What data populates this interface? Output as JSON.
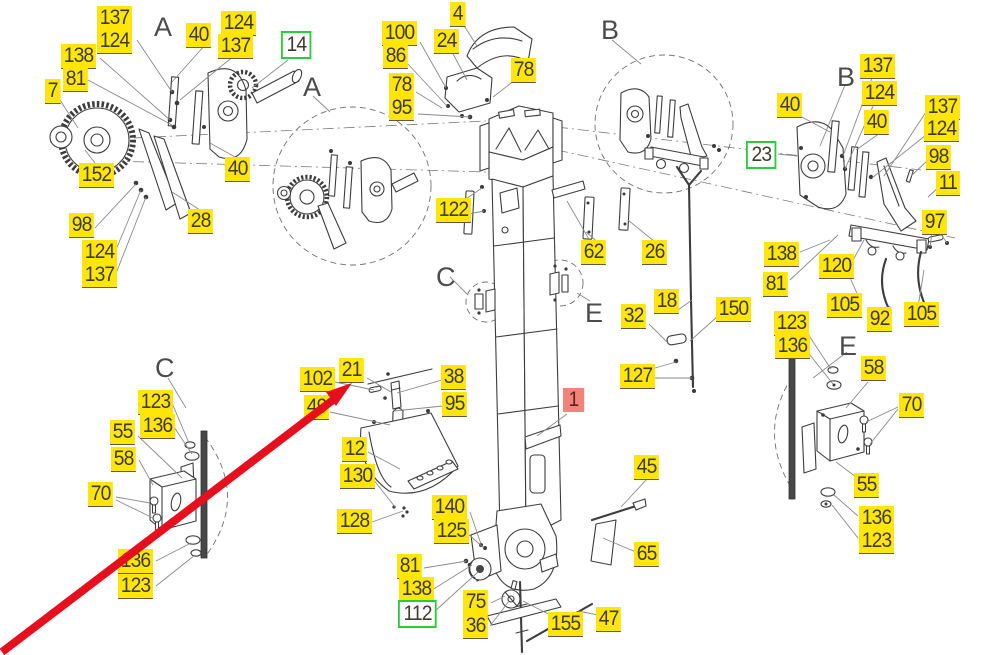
{
  "diagram": {
    "type": "exploded-parts-diagram",
    "colors": {
      "highlight": "#ffe608",
      "highlight_text": "#3f3b2e",
      "underline": "#5f5a48",
      "green_border": "#29cc3d",
      "red_bg": "#f2837b",
      "red_text": "#5c231e",
      "line": "#3d3d3d",
      "leader": "#8a8a8a",
      "arrow": "#e60f1e"
    },
    "labels": [
      {
        "text": "137",
        "x": 97,
        "y": 6,
        "kind": "yellow"
      },
      {
        "text": "124",
        "x": 97,
        "y": 29,
        "kind": "yellow"
      },
      {
        "text": "138",
        "x": 61,
        "y": 44,
        "kind": "yellow"
      },
      {
        "text": "81",
        "x": 63,
        "y": 67,
        "kind": "yellow"
      },
      {
        "text": "7",
        "x": 45,
        "y": 79,
        "kind": "yellow"
      },
      {
        "text": "40",
        "x": 186,
        "y": 23,
        "kind": "yellow"
      },
      {
        "text": "124",
        "x": 221,
        "y": 11,
        "kind": "yellow"
      },
      {
        "text": "137",
        "x": 218,
        "y": 34,
        "kind": "yellow"
      },
      {
        "text": "14",
        "x": 281,
        "y": 31,
        "kind": "green"
      },
      {
        "text": "152",
        "x": 79,
        "y": 163,
        "kind": "yellow"
      },
      {
        "text": "98",
        "x": 69,
        "y": 213,
        "kind": "yellow"
      },
      {
        "text": "124",
        "x": 82,
        "y": 240,
        "kind": "yellow"
      },
      {
        "text": "137",
        "x": 82,
        "y": 263,
        "kind": "yellow"
      },
      {
        "text": "28",
        "x": 188,
        "y": 209,
        "kind": "yellow"
      },
      {
        "text": "40",
        "x": 225,
        "y": 157,
        "kind": "yellow"
      },
      {
        "text": "100",
        "x": 382,
        "y": 21,
        "kind": "yellow"
      },
      {
        "text": "86",
        "x": 383,
        "y": 44,
        "kind": "yellow"
      },
      {
        "text": "78",
        "x": 389,
        "y": 73,
        "kind": "yellow"
      },
      {
        "text": "95",
        "x": 389,
        "y": 96,
        "kind": "yellow"
      },
      {
        "text": "4",
        "x": 450,
        "y": 2,
        "kind": "yellow"
      },
      {
        "text": "24",
        "x": 434,
        "y": 29,
        "kind": "yellow"
      },
      {
        "text": "78",
        "x": 511,
        "y": 58,
        "kind": "yellow"
      },
      {
        "text": "40",
        "x": 777,
        "y": 93,
        "kind": "yellow"
      },
      {
        "text": "137",
        "x": 860,
        "y": 54,
        "kind": "yellow"
      },
      {
        "text": "124",
        "x": 862,
        "y": 81,
        "kind": "yellow"
      },
      {
        "text": "40",
        "x": 864,
        "y": 110,
        "kind": "yellow"
      },
      {
        "text": "23",
        "x": 746,
        "y": 141,
        "kind": "green"
      },
      {
        "text": "137",
        "x": 925,
        "y": 95,
        "kind": "yellow"
      },
      {
        "text": "124",
        "x": 924,
        "y": 117,
        "kind": "yellow"
      },
      {
        "text": "98",
        "x": 926,
        "y": 145,
        "kind": "yellow"
      },
      {
        "text": "11",
        "x": 936,
        "y": 171,
        "kind": "yellow"
      },
      {
        "text": "97",
        "x": 922,
        "y": 210,
        "kind": "yellow"
      },
      {
        "text": "138",
        "x": 764,
        "y": 242,
        "kind": "yellow"
      },
      {
        "text": "81",
        "x": 763,
        "y": 272,
        "kind": "yellow"
      },
      {
        "text": "120",
        "x": 819,
        "y": 254,
        "kind": "yellow"
      },
      {
        "text": "105",
        "x": 827,
        "y": 293,
        "kind": "yellow"
      },
      {
        "text": "92",
        "x": 867,
        "y": 307,
        "kind": "yellow"
      },
      {
        "text": "105",
        "x": 904,
        "y": 302,
        "kind": "yellow"
      },
      {
        "text": "123",
        "x": 774,
        "y": 311,
        "kind": "yellow"
      },
      {
        "text": "136",
        "x": 775,
        "y": 334,
        "kind": "yellow"
      },
      {
        "text": "58",
        "x": 861,
        "y": 356,
        "kind": "yellow"
      },
      {
        "text": "70",
        "x": 899,
        "y": 393,
        "kind": "yellow"
      },
      {
        "text": "55",
        "x": 854,
        "y": 473,
        "kind": "yellow"
      },
      {
        "text": "136",
        "x": 859,
        "y": 506,
        "kind": "yellow"
      },
      {
        "text": "123",
        "x": 859,
        "y": 529,
        "kind": "yellow"
      },
      {
        "text": "122",
        "x": 436,
        "y": 198,
        "kind": "yellow"
      },
      {
        "text": "62",
        "x": 581,
        "y": 240,
        "kind": "yellow"
      },
      {
        "text": "26",
        "x": 642,
        "y": 240,
        "kind": "yellow"
      },
      {
        "text": "32",
        "x": 621,
        "y": 304,
        "kind": "yellow"
      },
      {
        "text": "18",
        "x": 654,
        "y": 289,
        "kind": "yellow"
      },
      {
        "text": "150",
        "x": 716,
        "y": 297,
        "kind": "yellow"
      },
      {
        "text": "127",
        "x": 620,
        "y": 364,
        "kind": "yellow"
      },
      {
        "text": "102",
        "x": 300,
        "y": 367,
        "kind": "yellow"
      },
      {
        "text": "21",
        "x": 339,
        "y": 358,
        "kind": "yellow"
      },
      {
        "text": "49",
        "x": 304,
        "y": 395,
        "kind": "yellow"
      },
      {
        "text": "38",
        "x": 441,
        "y": 365,
        "kind": "yellow"
      },
      {
        "text": "95",
        "x": 442,
        "y": 392,
        "kind": "yellow"
      },
      {
        "text": "12",
        "x": 342,
        "y": 437,
        "kind": "yellow"
      },
      {
        "text": "130",
        "x": 340,
        "y": 464,
        "kind": "yellow"
      },
      {
        "text": "128",
        "x": 337,
        "y": 509,
        "kind": "yellow"
      },
      {
        "text": "140",
        "x": 432,
        "y": 495,
        "kind": "yellow"
      },
      {
        "text": "125",
        "x": 434,
        "y": 519,
        "kind": "yellow"
      },
      {
        "text": "1",
        "x": 563,
        "y": 388,
        "kind": "red"
      },
      {
        "text": "45",
        "x": 634,
        "y": 455,
        "kind": "yellow"
      },
      {
        "text": "65",
        "x": 634,
        "y": 542,
        "kind": "yellow"
      },
      {
        "text": "81",
        "x": 397,
        "y": 554,
        "kind": "yellow"
      },
      {
        "text": "138",
        "x": 399,
        "y": 577,
        "kind": "yellow"
      },
      {
        "text": "112",
        "x": 398,
        "y": 600,
        "kind": "green"
      },
      {
        "text": "75",
        "x": 463,
        "y": 590,
        "kind": "yellow"
      },
      {
        "text": "36",
        "x": 463,
        "y": 614,
        "kind": "yellow"
      },
      {
        "text": "155",
        "x": 548,
        "y": 612,
        "kind": "yellow"
      },
      {
        "text": "47",
        "x": 596,
        "y": 607,
        "kind": "yellow"
      },
      {
        "text": "123",
        "x": 138,
        "y": 390,
        "kind": "yellow"
      },
      {
        "text": "136",
        "x": 140,
        "y": 414,
        "kind": "yellow"
      },
      {
        "text": "55",
        "x": 110,
        "y": 420,
        "kind": "yellow"
      },
      {
        "text": "58",
        "x": 111,
        "y": 447,
        "kind": "yellow"
      },
      {
        "text": "70",
        "x": 88,
        "y": 482,
        "kind": "yellow"
      },
      {
        "text": "136",
        "x": 118,
        "y": 549,
        "kind": "yellow"
      },
      {
        "text": "123",
        "x": 118,
        "y": 574,
        "kind": "yellow"
      }
    ],
    "section_letters": [
      {
        "text": "A",
        "x": 154,
        "y": 12
      },
      {
        "text": "A",
        "x": 303,
        "y": 72
      },
      {
        "text": "B",
        "x": 601,
        "y": 15
      },
      {
        "text": "B",
        "x": 837,
        "y": 62
      },
      {
        "text": "C",
        "x": 436,
        "y": 262
      },
      {
        "text": "C",
        "x": 155,
        "y": 353
      },
      {
        "text": "E",
        "x": 585,
        "y": 298
      },
      {
        "text": "E",
        "x": 839,
        "y": 331
      }
    ]
  }
}
